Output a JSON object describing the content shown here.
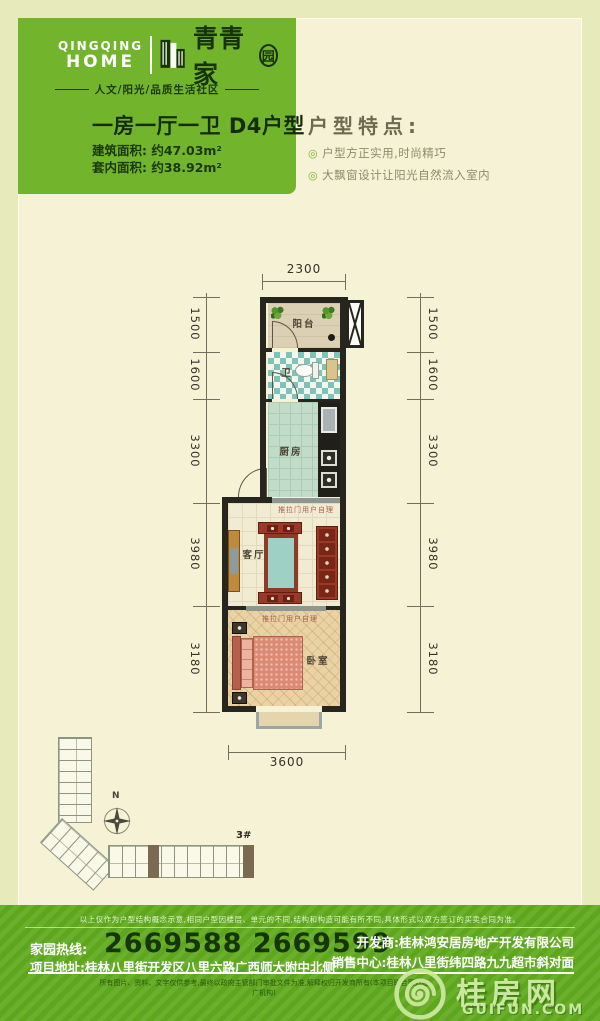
{
  "brand": {
    "en_line1": "QINGQING",
    "en_line2": "HOME",
    "cn_main": "青青家",
    "cn_last": "园",
    "tagline": "人文/阳光/品质生活社区"
  },
  "unit": {
    "title_rooms": "一房一厅一卫",
    "title_type": "D4户型",
    "area_built": "建筑面积: 约47.03m²",
    "area_inner": "套内面积: 约38.92m²"
  },
  "features": {
    "heading": "户型特点:",
    "bullet": "◎",
    "items": [
      "户型方正实用,时尚精巧",
      "大飘窗设计让阳光自然流入室内"
    ]
  },
  "floorplan": {
    "dim_top": "2300",
    "dim_bottom": "3600",
    "dims_left": [
      "1500",
      "1600",
      "3300",
      "3980",
      "3180"
    ],
    "dims_right": [
      "1500",
      "1600",
      "3300",
      "3980",
      "3180"
    ],
    "labels": {
      "balcony": "阳台",
      "bath": "卫",
      "kitchen": "厨房",
      "living": "客厅",
      "bedroom": "卧室"
    },
    "note_sliding": "推拉门用户自理"
  },
  "siteplan": {
    "north": "N",
    "building": "3#"
  },
  "footer": {
    "disclaimer_top": "以上仅作为户型结构概念示意,相同户型因楼层、单元的不同,结构和构造可能有所不同,具体形式以双方签订的买卖合同为准。",
    "hotline_label": "家园热线:",
    "hotline": "2669588 2669599",
    "address": "项目地址:桂林八里街开发区八里六路广西师大附中北侧",
    "developer": "开发商:桂林鸿安居房地产开发有限公司",
    "sales": "销售中心:桂林八里街纬四路九九超市斜对面",
    "disclaimer_bottom": "所有图片、资料、文字仅供参考,最终以政府主管部门审批文件为准,解释权归开发商所有(本项目联合策划推广机构)",
    "watermark_cn": "桂房网",
    "watermark_en": "GUIFUN.COM"
  }
}
